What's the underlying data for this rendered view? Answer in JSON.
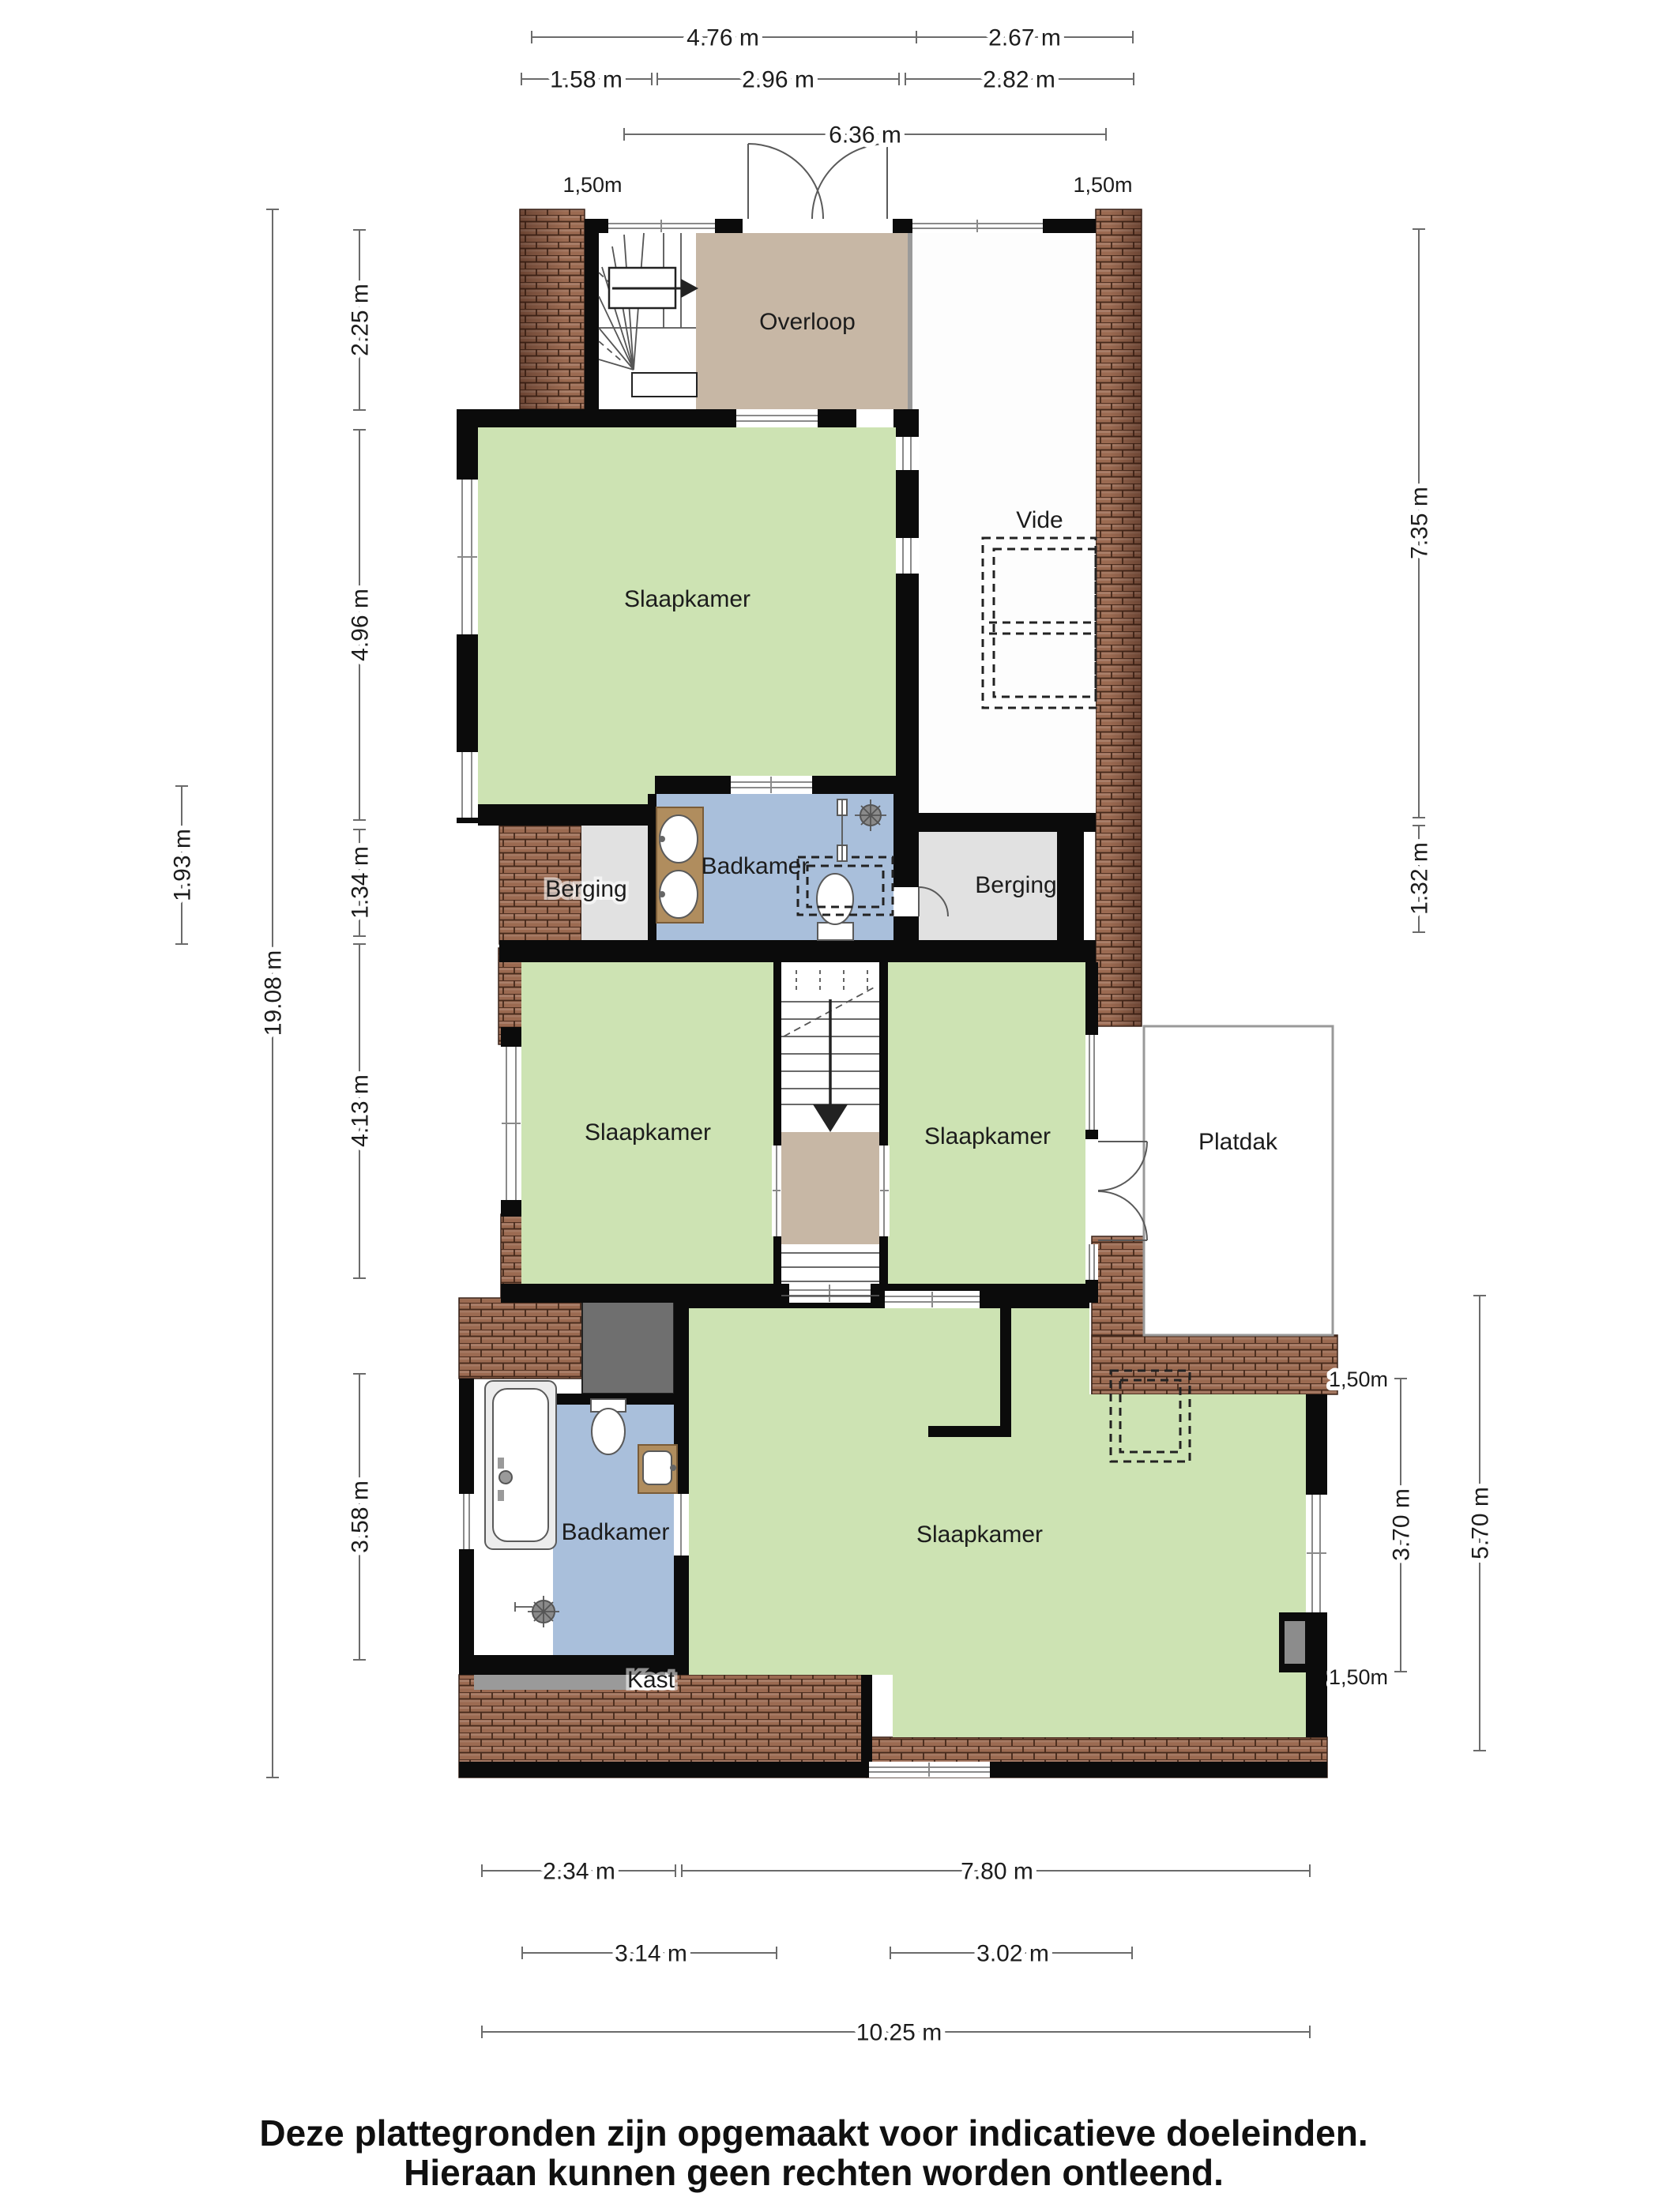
{
  "footer": {
    "line1": "Deze plattegronden zijn opgemaakt voor indicatieve doeleinden.",
    "line2": "Hieraan kunnen geen rechten worden ontleend."
  },
  "rooms": {
    "overloop": "Overloop",
    "slaapkamer_top": "Slaapkamer",
    "vide": "Vide",
    "berging_left": "Berging",
    "badkamer_mid": "Badkamer",
    "berging_right": "Berging",
    "slaapkamer_mid_left": "Slaapkamer",
    "slaapkamer_mid_right": "Slaapkamer",
    "platdak": "Platdak",
    "badkamer_bottom": "Badkamer",
    "kast": "Kast",
    "slaapkamer_bottom": "Slaapkamer"
  },
  "dimensions": {
    "top": {
      "d476": "4.76 m",
      "d267": "2.67 m",
      "d158": "1.58 m",
      "d296": "2.96 m",
      "d282": "2.82 m",
      "d636": "6.36 m",
      "h150_left": "1,50m",
      "h150_right": "1,50m"
    },
    "left": {
      "d225": "2.25 m",
      "d496": "4.96 m",
      "d134": "1.34 m",
      "d413": "4.13 m",
      "d358": "3.58 m",
      "d193": "1.93 m",
      "d1908": "19.08 m"
    },
    "right": {
      "d735": "7.35 m",
      "d132": "1.32 m",
      "d370": "3.70 m",
      "d570": "5.70 m",
      "h150_top": "1,50m",
      "h150_bottom": "1,50m"
    },
    "bottom": {
      "d234": "2.34 m",
      "d780": "7.80 m",
      "d314": "3.14 m",
      "d302": "3.02 m",
      "d1025": "10.25 m"
    }
  },
  "colors": {
    "wall": "#0b0b0b",
    "room_green": "#cde3b3",
    "room_blue": "#a9bfdb",
    "room_tan": "#c7b7a5",
    "room_gray": "#e1e1e1",
    "dark_gray": "#6f6f6f",
    "roof": "#9b6a51",
    "dim_line": "#6b6b6b",
    "text": "#1c1c1c"
  }
}
